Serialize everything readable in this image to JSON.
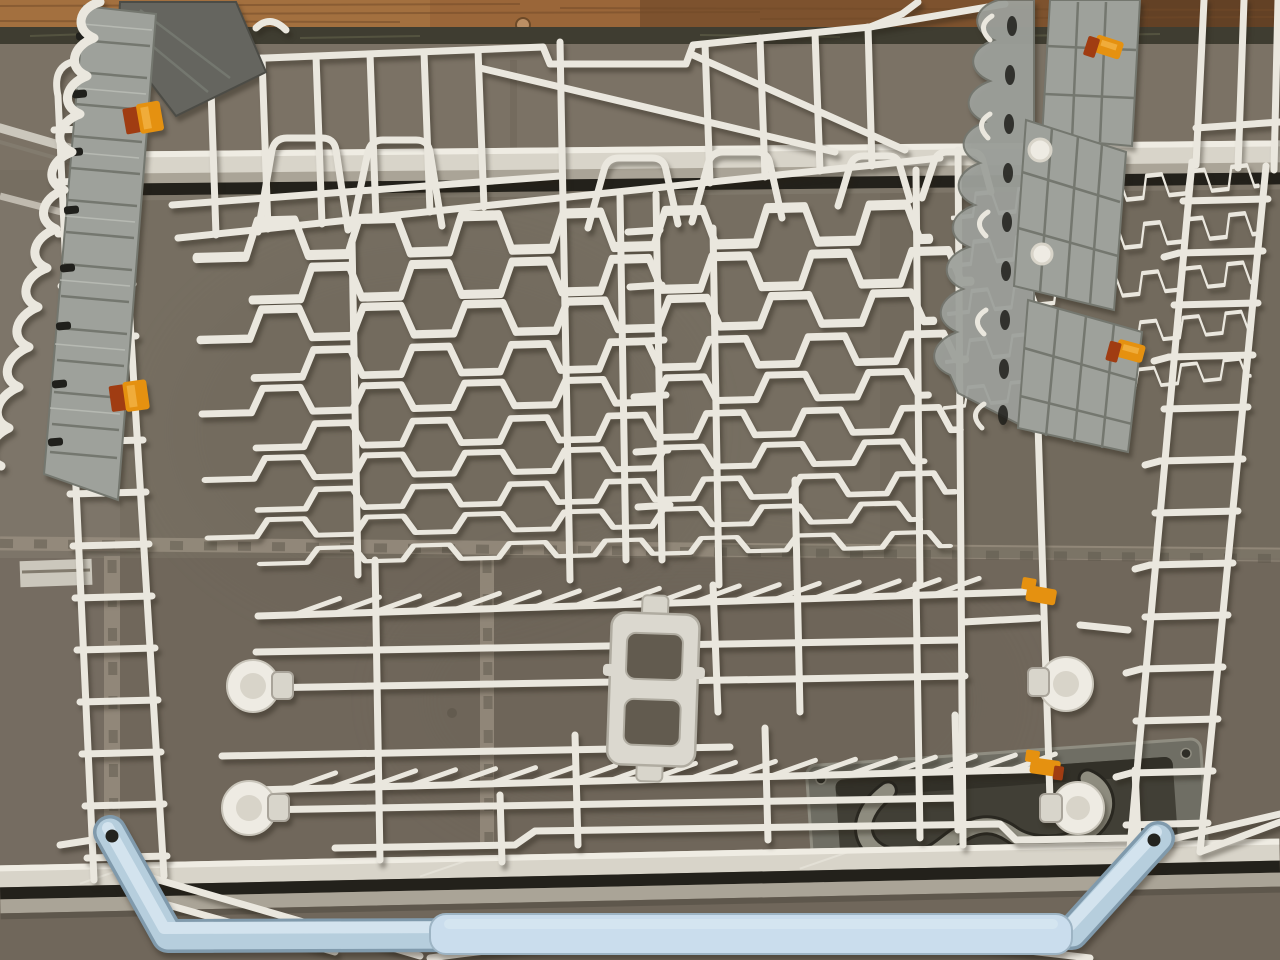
{
  "scene": {
    "type": "photograph",
    "subject": "White wire upper dishwasher basket resting on taupe floor tiles in front of a wooden plank",
    "setting": "gray-brown ceramic tiles with textured grout lines, two metal trim strips, a wooden plank along the top edge, a recessed cast-metal floor hatch handle at the lower right",
    "objects": [
      "wooden-plank",
      "plank-screw",
      "floor-tiles",
      "grout-lines",
      "metal-corner-frame",
      "upper-trim-strip",
      "lower-trim-strip",
      "recessed-hatch-handle",
      "wire-basket",
      "left-fold-down-shelf",
      "right-fold-down-shelf",
      "shelf-hinge-scallops",
      "orange-locking-clips",
      "roller-wheels",
      "axle-caps",
      "stemware-tine-rows",
      "center-plastic-bracket",
      "light-blue-handle",
      "handle-grip-pad"
    ],
    "counts": {
      "roller_wheels": 4,
      "orange_clips": 6,
      "fold_down_shelves": 2,
      "tine_rows": 2
    },
    "palette": {
      "wood1": "#9a6639",
      "woodDark": "#5c3a21",
      "plankEdge": "#3f3d31",
      "screw": "#bb8f64",
      "tile": "#766e61",
      "tileLight": "#8c8477",
      "tileDark": "#625b4f",
      "grout": "#988f80",
      "groutDark": "#5e574c",
      "trim": "#d8d4c9",
      "trimHi": "#efece3",
      "trimLo": "#aaa497",
      "slotC": "#23211b",
      "metal": "#cbc7bc",
      "metalDark": "#827b6e",
      "wire": "#eae7de",
      "wireDim": "#c9c5ba",
      "shelf": "#9ea19b",
      "shelfLine": "#74776f",
      "shelfDark": "#65655f",
      "shelfSlot": "#20201c",
      "orange": "#e59110",
      "orangeDark": "#a03c12",
      "blue": "#b6cedd",
      "blueHi": "#d6e6f0",
      "blueLo": "#809aac",
      "grip": "#cadded",
      "wheel": "#eeebe3",
      "wheelIn": "#d8d4c9",
      "cap": "#d8d5cb",
      "plate": "#6f6e64",
      "recess": "#413f36",
      "loop": "#8e8c7f"
    }
  }
}
